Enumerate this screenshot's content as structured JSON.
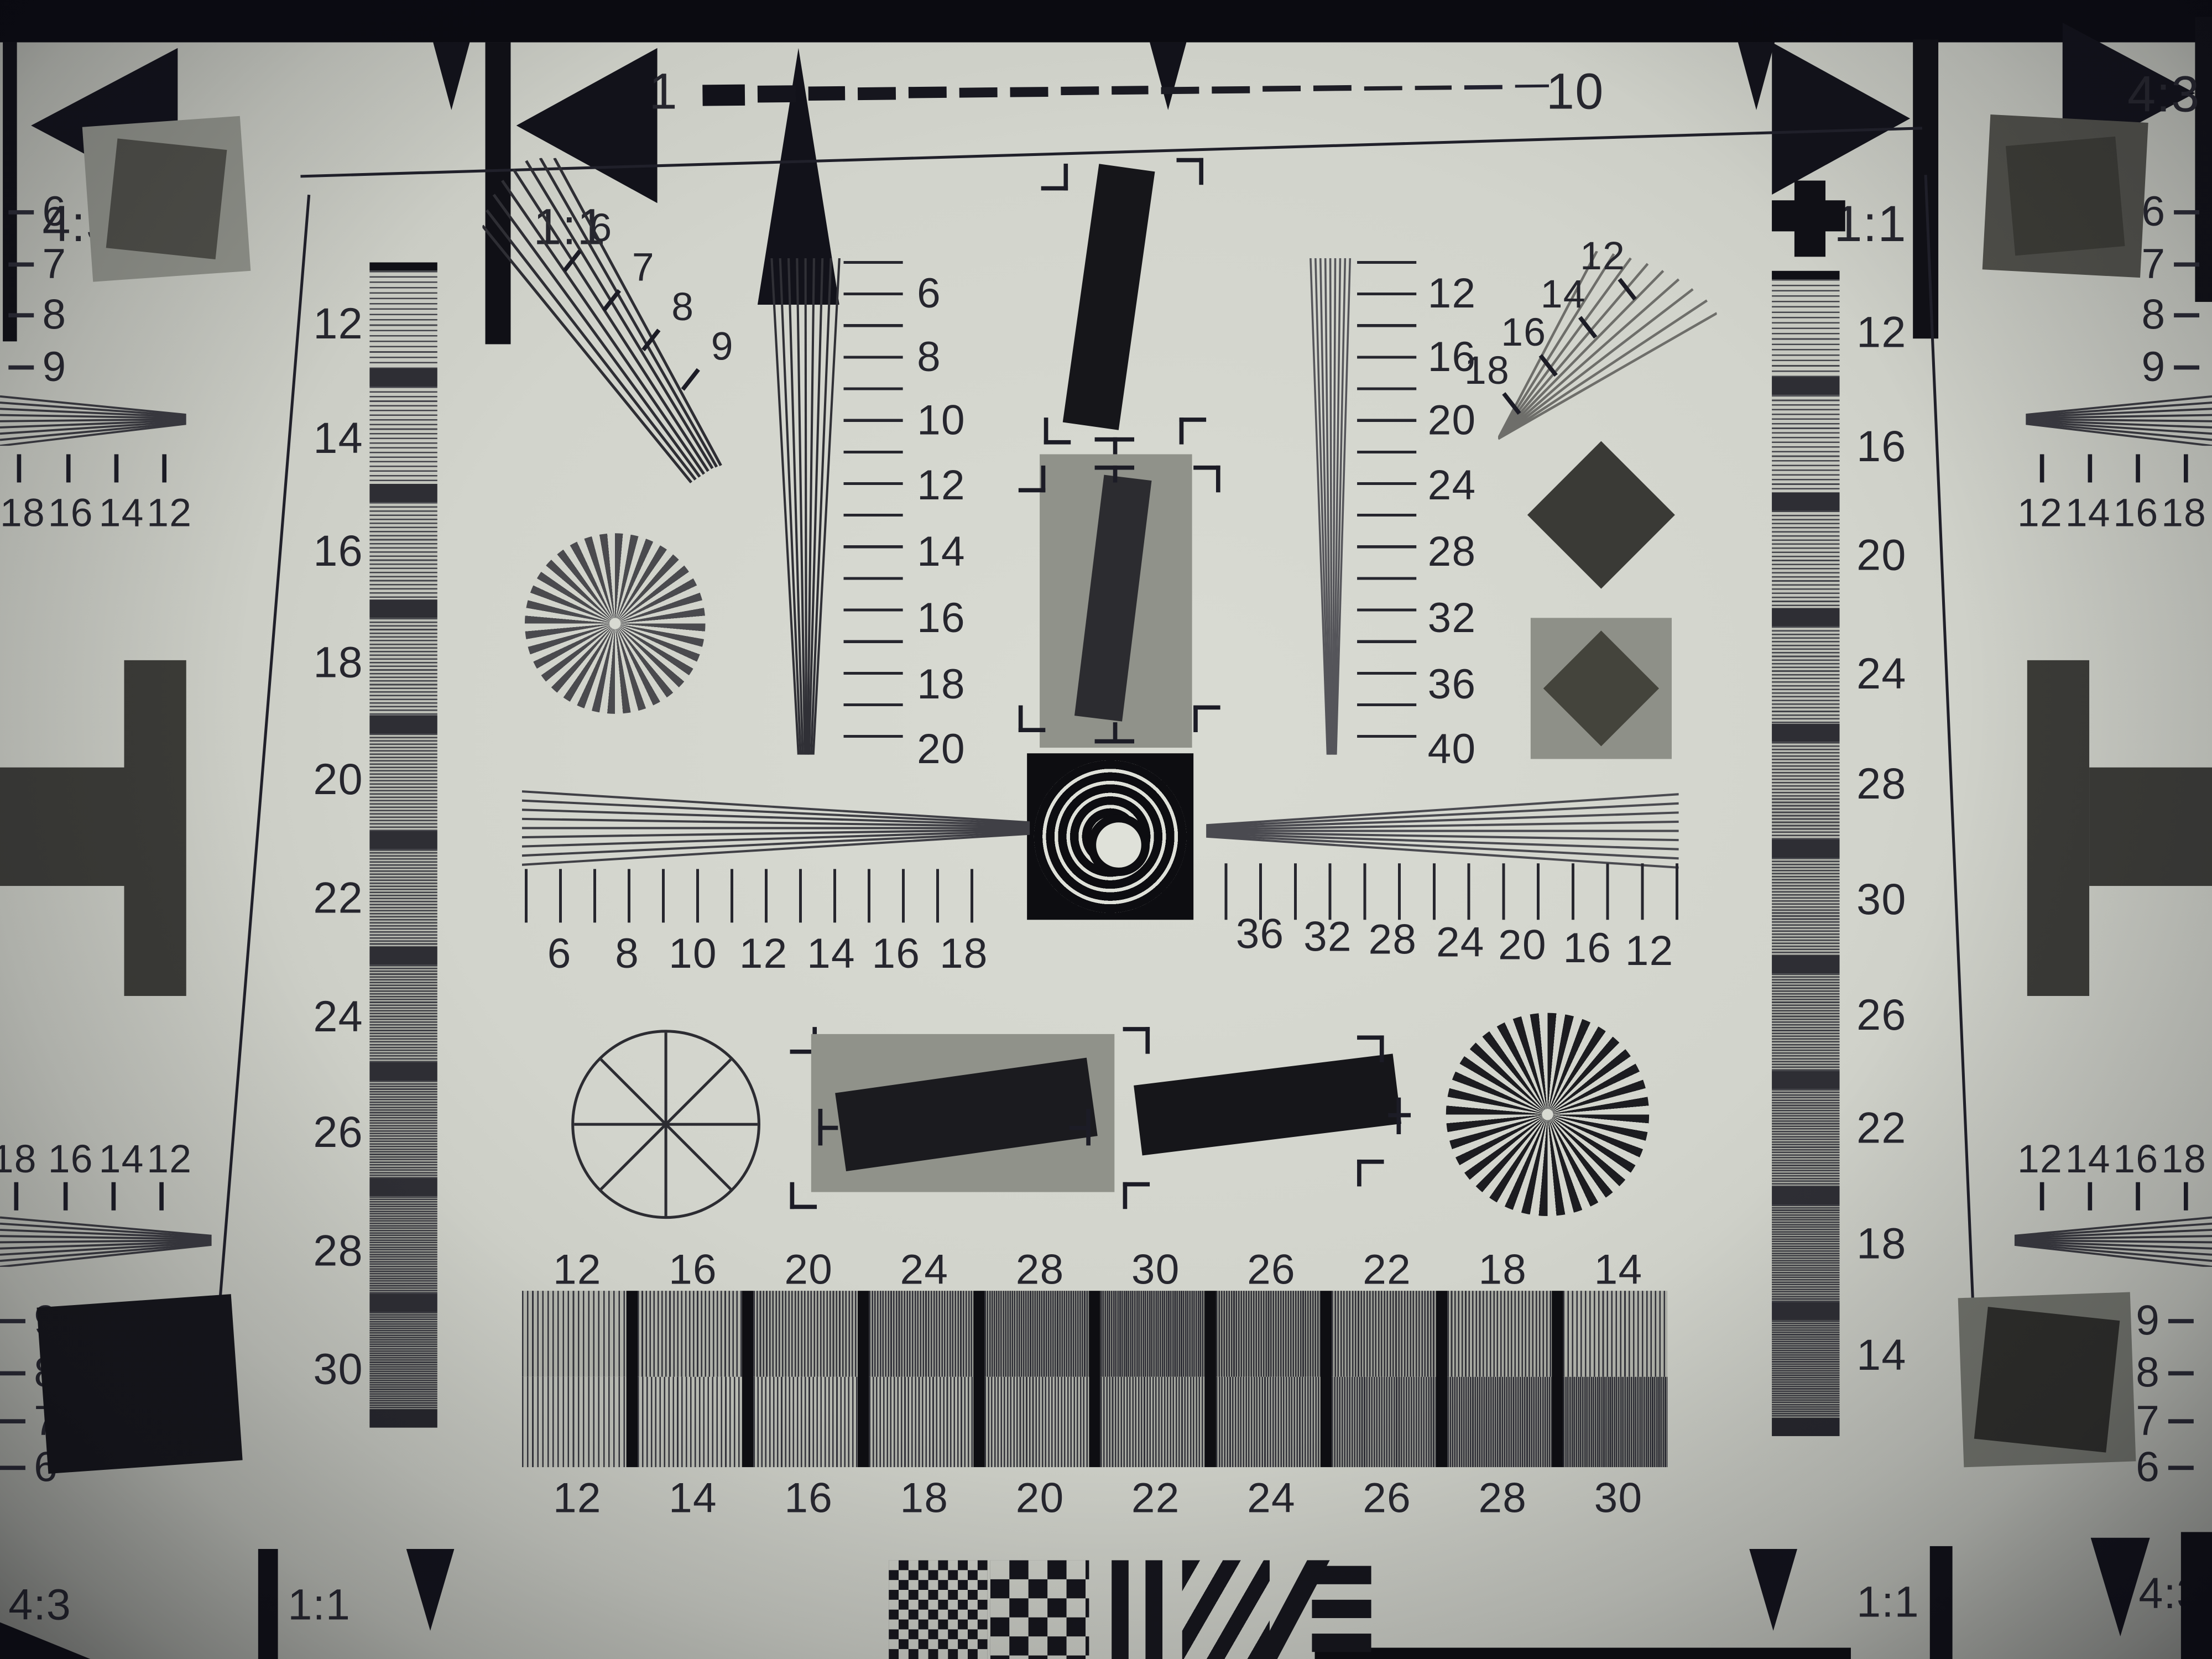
{
  "aspect_markers": {
    "top_left_43": "4:3",
    "top_left_11": "1:1",
    "top_right_11": "1:1",
    "top_right_43": "4:3",
    "bottom_left_43": "4:3",
    "bottom_left_11": "1:1",
    "bottom_right_11": "1:1",
    "bottom_right_43": "4:3"
  },
  "top_ruler": {
    "start": "1",
    "end": "10"
  },
  "left_margin": {
    "upper_scale": [
      "6",
      "7",
      "8",
      "9"
    ],
    "upper_wedge_scale": [
      "18",
      "16",
      "14",
      "12"
    ],
    "lower_wedge_scale": [
      "18",
      "16",
      "14",
      "12"
    ],
    "lower_scale": [
      "9",
      "8",
      "7",
      "6"
    ]
  },
  "right_margin": {
    "upper_scale": [
      "6",
      "7",
      "8",
      "9"
    ],
    "upper_wedge_scale": [
      "12",
      "14",
      "16",
      "18"
    ],
    "lower_wedge_scale": [
      "12",
      "14",
      "16",
      "18"
    ],
    "lower_scale": [
      "9",
      "8",
      "7",
      "6"
    ]
  },
  "grayscale_left": {
    "labels": [
      "12",
      "14",
      "16",
      "18",
      "20",
      "22",
      "24",
      "26",
      "28",
      "30"
    ]
  },
  "grayscale_right": {
    "labels": [
      "12",
      "16",
      "20",
      "24",
      "28",
      "30",
      "26",
      "22",
      "18",
      "14"
    ]
  },
  "center": {
    "nw_fan_labels": [
      "6",
      "7",
      "8",
      "9"
    ],
    "ne_fan_labels": [
      "12",
      "14",
      "16",
      "18"
    ],
    "left_vertical_scale": [
      "6",
      "8",
      "10",
      "12",
      "14",
      "16",
      "18",
      "20"
    ],
    "right_vertical_scale": [
      "12",
      "16",
      "20",
      "24",
      "28",
      "32",
      "36",
      "40"
    ],
    "left_horizontal_scale": [
      "6",
      "8",
      "10",
      "12",
      "14",
      "16",
      "18"
    ],
    "right_horizontal_scale": [
      "36",
      "32",
      "28",
      "24",
      "20",
      "16",
      "12"
    ]
  },
  "bottom_row": {
    "top_labels": [
      "12",
      "16",
      "20",
      "24",
      "28",
      "30",
      "26",
      "22",
      "18",
      "14"
    ],
    "bottom_labels": [
      "12",
      "14",
      "16",
      "18",
      "20",
      "22",
      "24",
      "26",
      "28",
      "30"
    ]
  },
  "colors": {
    "paper": "#d4d6cc",
    "ink": "#26262e",
    "black": "#0e0e12",
    "gray_patch": "#90928a",
    "dark_gray": "#3b3b37"
  }
}
